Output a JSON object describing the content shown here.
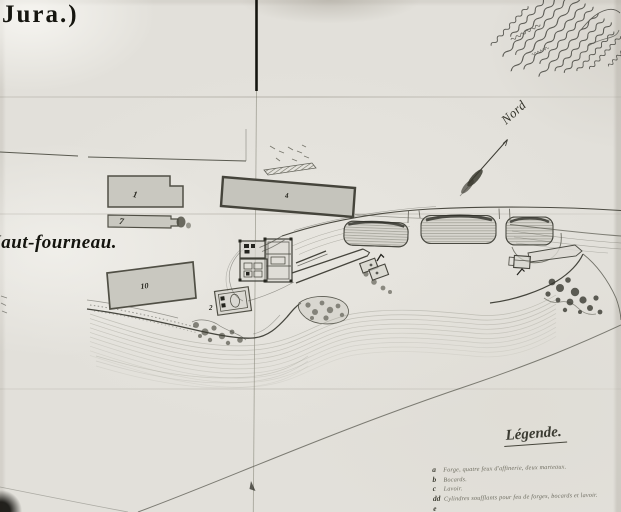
{
  "page": {
    "region_label": "Jura.)",
    "site_label": "Haut-fourneau.",
    "north_label": "Nord"
  },
  "buildings": {
    "labels": [
      "1",
      "7",
      "4",
      "10",
      "2"
    ]
  },
  "legend": {
    "title": "Légende.",
    "entries": [
      {
        "letter": "a",
        "text": "Forge, quatre feux d'affinerie, deux marteaux."
      },
      {
        "letter": "b",
        "text": "Bocards."
      },
      {
        "letter": "c",
        "text": "Lavoir."
      },
      {
        "letter": "dd",
        "text": "Cylindres soufflants pour feu de forges, bocards et lavoir."
      },
      {
        "letter": "e",
        "text": ""
      }
    ]
  },
  "colors": {
    "paper": "#e2e0da",
    "ink": "#3a3a32",
    "building_fill": "#c9c8c0",
    "building_stroke": "#504f45",
    "water_line": "#8f8e82"
  }
}
